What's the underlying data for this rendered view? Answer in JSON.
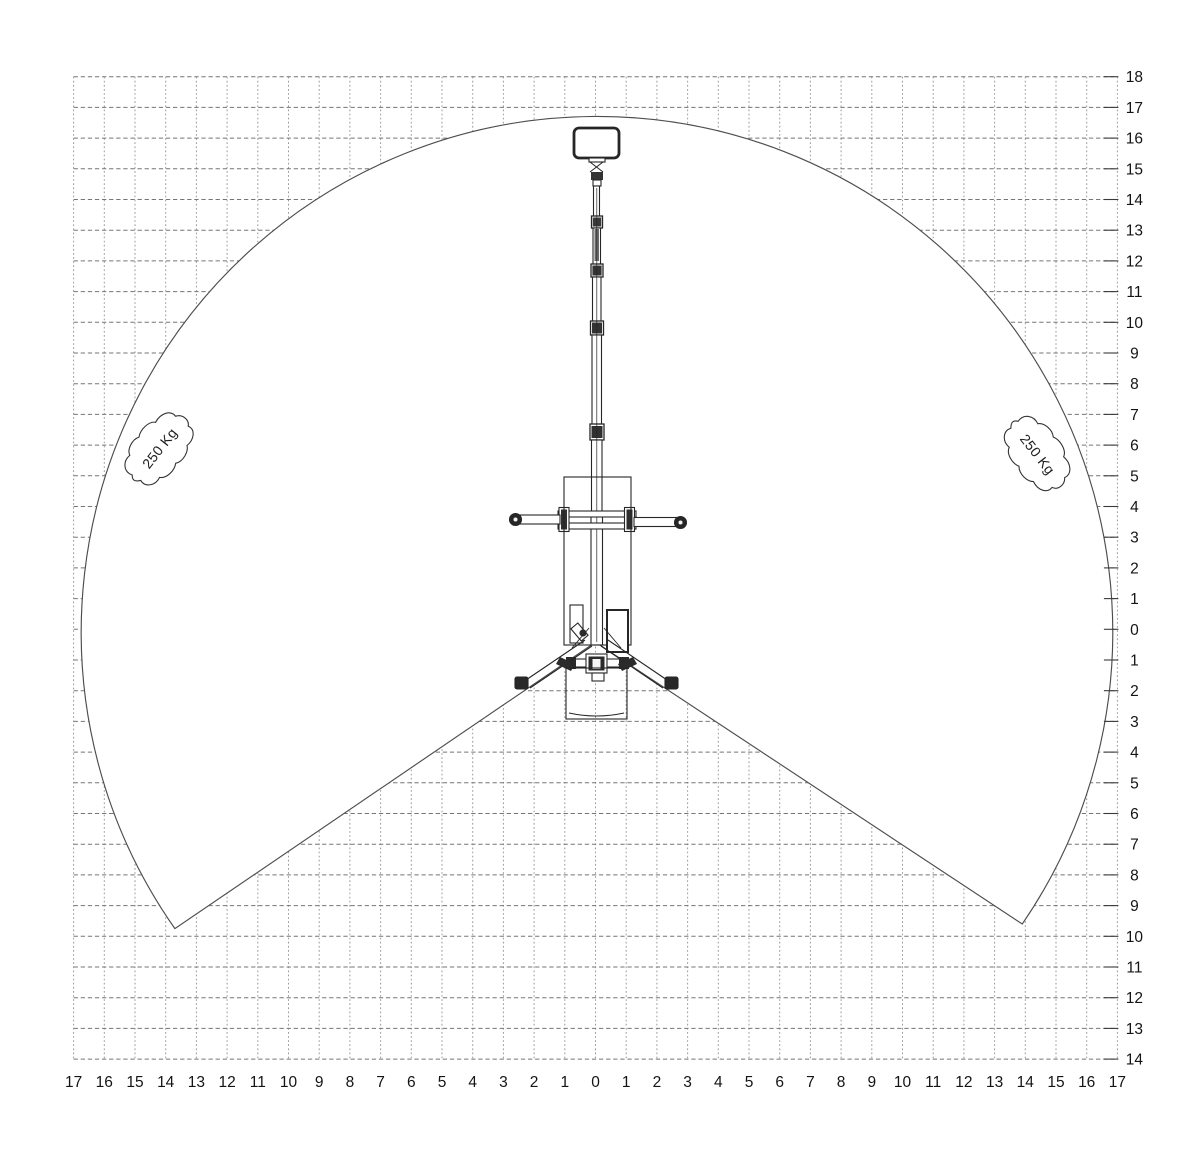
{
  "page": {
    "background": "#ffffff",
    "line_color": "#262626",
    "grid_color": "#8c8c8c",
    "boundary_color": "#4d4d4d"
  },
  "chart_data": {
    "type": "other",
    "subtype": "aerial-work-platform-working-envelope-diagram",
    "title": "",
    "units": "m",
    "grid": {
      "spacing": 1,
      "style": "dashed",
      "visible": true
    },
    "x_axis": {
      "range": [
        -17,
        17
      ],
      "label_values": [
        17,
        16,
        15,
        14,
        13,
        12,
        11,
        10,
        9,
        8,
        7,
        6,
        5,
        4,
        3,
        2,
        1,
        0,
        1,
        2,
        3,
        4,
        5,
        6,
        7,
        8,
        9,
        10,
        11,
        12,
        13,
        14,
        15,
        16,
        17
      ]
    },
    "y_axis": {
      "range_top": 18,
      "range_bottom": -14,
      "label_values": [
        18,
        17,
        16,
        15,
        14,
        13,
        12,
        11,
        10,
        9,
        8,
        7,
        6,
        5,
        4,
        3,
        2,
        1,
        0,
        1,
        2,
        3,
        4,
        5,
        6,
        7,
        8,
        9,
        10,
        11,
        12,
        13,
        14
      ]
    },
    "envelope": {
      "shape": "circle-with-bottom-wedge-cutout",
      "center": [
        0,
        0
      ],
      "radius": 16.8,
      "wedge_apex": [
        0,
        -0.42
      ],
      "wedge_left_end": [
        -13.7,
        -9.75
      ],
      "wedge_right_end": [
        13.9,
        -9.6
      ],
      "rated_capacity": "250 Kg"
    },
    "capacity_badges": [
      {
        "text": "250 Kg",
        "x": -14.2,
        "y": 5.9,
        "rotation": -52
      },
      {
        "text": "250 Kg",
        "x": 14.4,
        "y": 5.7,
        "rotation": 52
      }
    ]
  }
}
